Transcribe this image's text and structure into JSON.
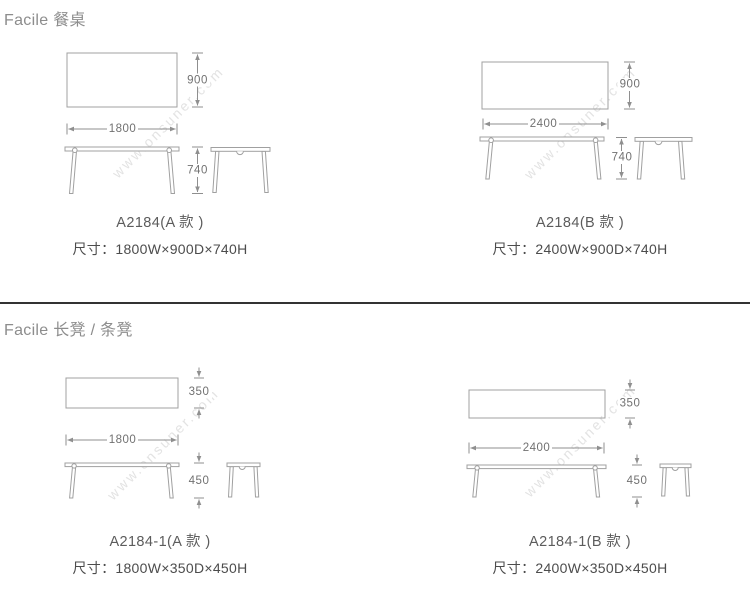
{
  "watermark": "www.onsuner.com",
  "colors": {
    "background": "#ffffff",
    "drawing_line": "#a0a0a0",
    "dimension_line": "#8f8f8f",
    "dimension_text": "#717171",
    "header_text": "#8d8d8d",
    "label_text": "#4c4c4c",
    "divider": "#333333",
    "watermark_text": "#e3e3e3"
  },
  "sections": [
    {
      "header": "Facile 餐桌",
      "products": [
        {
          "model": "A2184(A 款 )",
          "size": "尺寸：1800W×900D×740H",
          "dim_width": "1800",
          "dim_depth": "900",
          "dim_height": "740"
        },
        {
          "model": "A2184(B 款 )",
          "size": "尺寸：2400W×900D×740H",
          "dim_width": "2400",
          "dim_depth": "900",
          "dim_height": "740"
        }
      ]
    },
    {
      "header": "Facile 长凳 / 条凳",
      "products": [
        {
          "model": "A2184-1(A 款 )",
          "size": "尺寸：1800W×350D×450H",
          "dim_width": "1800",
          "dim_depth": "350",
          "dim_height": "450"
        },
        {
          "model": "A2184-1(B 款 )",
          "size": "尺寸：2400W×350D×450H",
          "dim_width": "2400",
          "dim_depth": "350",
          "dim_height": "450"
        }
      ]
    }
  ]
}
